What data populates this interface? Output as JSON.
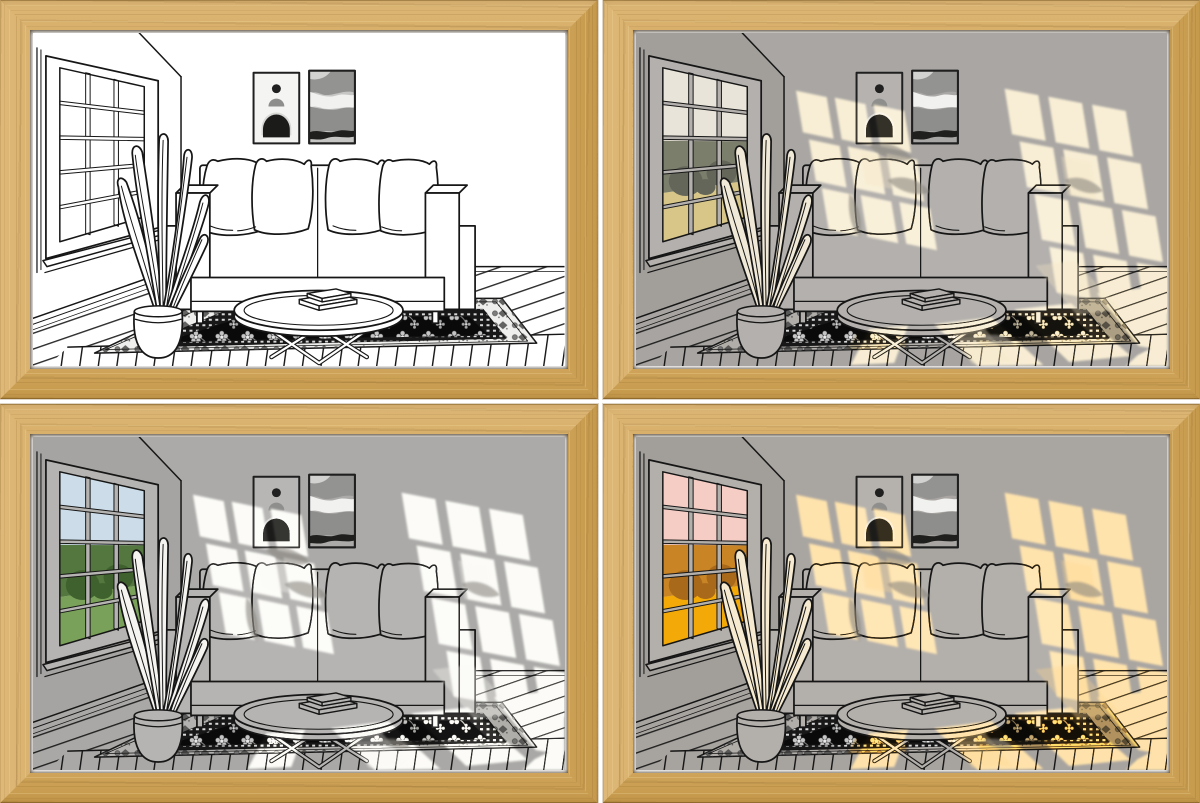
{
  "page": {
    "description": "Product image grid: one framed line-art living-room light painting shown in four lighting modes",
    "background": "#ffffff",
    "grid": {
      "rows": 2,
      "cols": 2,
      "gap_px": 5
    }
  },
  "frame": {
    "wood_base": "#d5ac63",
    "wood_mid": "#cda257",
    "wood_light": "#e9cc92",
    "wood_dark": "#b68a41",
    "edge_line": "#8a6428",
    "mat": "#ffffff",
    "gap": "#ffffff"
  },
  "scene": {
    "line_color": "#161616",
    "elements": [
      "window",
      "plant-in-pot",
      "two-wall-posters",
      "sofa-with-four-pillows",
      "round-coffee-table-with-books",
      "oriental-rug",
      "plank-floor",
      "sunlight-patches"
    ]
  },
  "modes": [
    {
      "label": "Frame 1: light off — black and white line art",
      "vars": {
        "wall": "#ffffff",
        "sidewall": "#ffffff",
        "floor": "#ffffff",
        "object": "#ffffff",
        "leaf": "#ffffff",
        "poster": "#f4f4f2",
        "poster2": "#c6c6c4",
        "rugband": "#efefed",
        "gsky": "#ffffff",
        "gtree": "#ffffff",
        "gtreed": "#ffffff",
        "ggrass": "#ffffff",
        "light": "#ffffff",
        "lo": "0"
      }
    },
    {
      "label": "Frame 2: warm ambient light — grey room with soft cream window light",
      "vars": {
        "wall": "#a9a6a3",
        "sidewall": "#a29f9b",
        "floor": "#a7a4a1",
        "object": "#b3b0ad",
        "leaf": "#f1e9d7",
        "poster": "#b5b2af",
        "poster2": "#a9a7a5",
        "rugband": "#b1aeaa",
        "gsky": "#e8e4d9",
        "gtree": "#7c7e6c",
        "gtreed": "#64665a",
        "ggrass": "#d7c687",
        "light": "#f6e7c5",
        "lo": "1"
      }
    },
    {
      "label": "Frame 3: bright daylight — grey room with white window light and green view",
      "vars": {
        "wall": "#abaaa8",
        "sidewall": "#a5a4a2",
        "floor": "#a9a8a6",
        "object": "#b5b4b2",
        "leaf": "#f5f4f1",
        "poster": "#b7b6b4",
        "poster2": "#abaaa8",
        "rugband": "#b3b2b0",
        "gsky": "#ccdde9",
        "gtree": "#54773f",
        "gtreed": "#3f612e",
        "ggrass": "#7aa159",
        "light": "#fbfaf5",
        "lo": "1"
      }
    },
    {
      "label": "Frame 4: golden hour — grey room with golden sunset light and orange view",
      "vars": {
        "wall": "#a9a5a1",
        "sidewall": "#a29e99",
        "floor": "#a7a39f",
        "object": "#b3afab",
        "leaf": "#f6ead0",
        "poster": "#b5b1ad",
        "poster2": "#a9a5a2",
        "rugband": "#b1ada9",
        "gsky": "#f5cdc5",
        "gtree": "#c98425",
        "gtreed": "#a8691a",
        "ggrass": "#f3a908",
        "light": "#ffd88f",
        "lo": "1"
      }
    }
  ]
}
